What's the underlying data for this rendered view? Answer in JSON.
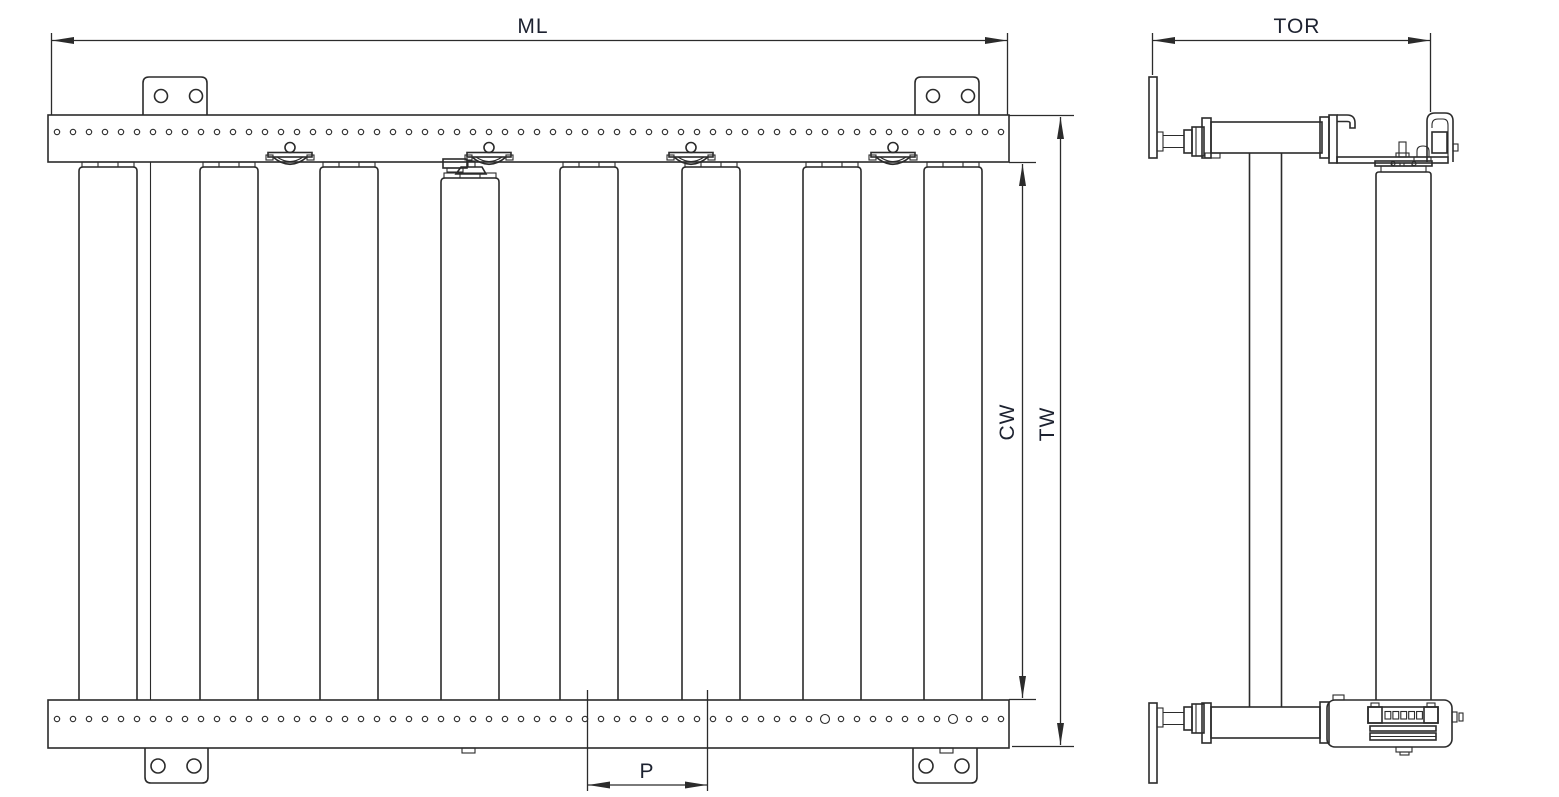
{
  "document": {
    "kind": "engineering-line-drawing",
    "subject": "roller conveyor",
    "views": [
      "plan-view",
      "end-view"
    ]
  },
  "colors": {
    "background": "#ffffff",
    "line": "#2b2b2b",
    "label": "#1d2230"
  },
  "dimensions": {
    "ml": {
      "label": "ML"
    },
    "tor": {
      "label": "TOR"
    },
    "cw": {
      "label": "CW"
    },
    "tw": {
      "label": "TW"
    },
    "p": {
      "label": "P"
    }
  },
  "plan_view": {
    "roller_count": 8,
    "motorized_roller_index": 3,
    "roller_clip_count": 4,
    "top_rail_hole_count": 60,
    "bottom_rail_hole_count": 60,
    "bottom_rail_large_hole_indices": [
      48,
      56
    ],
    "mounting_bracket_count": 4,
    "bracket_hole_count": 2
  },
  "end_view": {
    "support_count": 2,
    "chain_link_count": 5
  }
}
